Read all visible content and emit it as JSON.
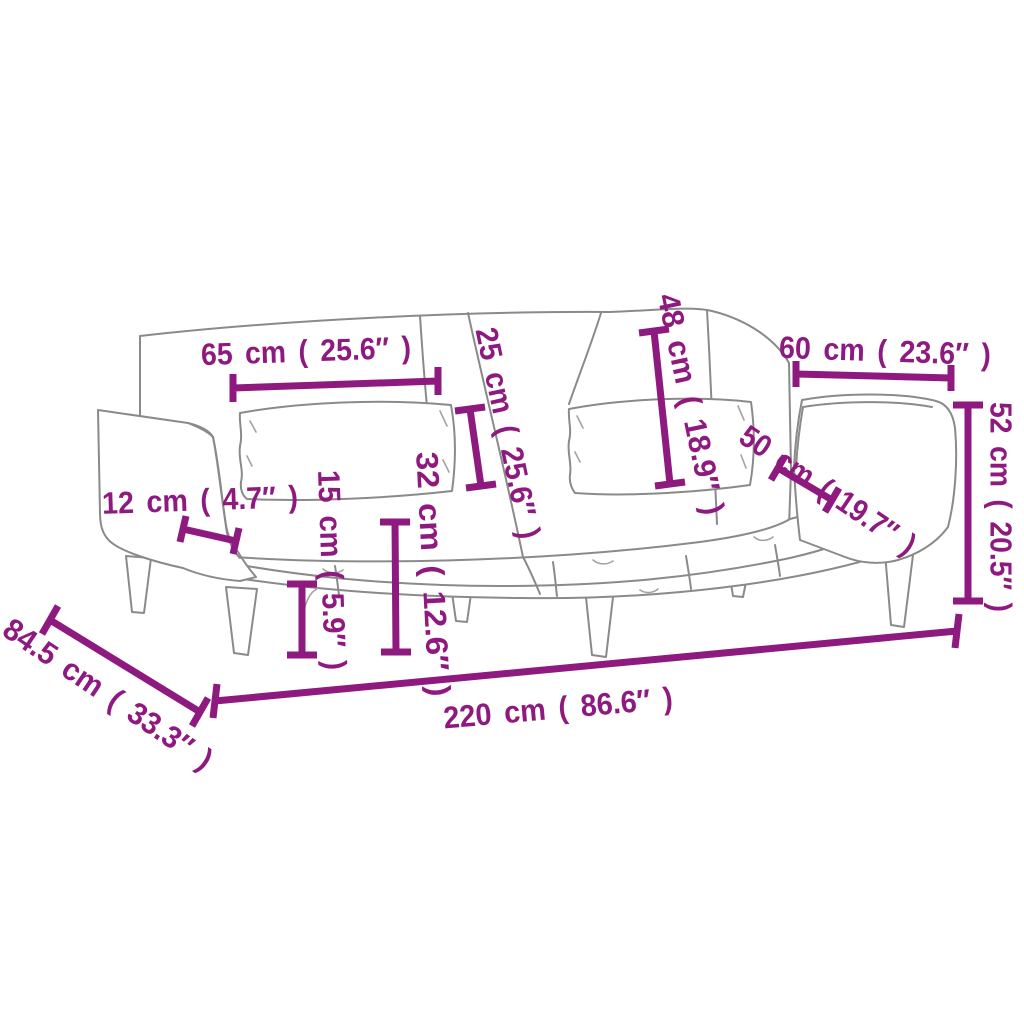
{
  "diagram": {
    "subject": "sofa-bed-dimension-diagram",
    "accent_color": "#8e1a80",
    "line_color": "#8a8a8a",
    "background_color": "#ffffff",
    "unit_primary": "cm",
    "unit_secondary": "inch"
  },
  "dimensions": [
    {
      "id": "dim-65",
      "label": "65 cm ( 25.6″ )"
    },
    {
      "id": "dim-25",
      "label": "25 cm ( 25.6″ )"
    },
    {
      "id": "dim-48",
      "label": "48 cm ( 18.9″ )"
    },
    {
      "id": "dim-60",
      "label": "60 cm ( 23.6″ )"
    },
    {
      "id": "dim-50",
      "label": "50 cm ( 19.7″ )"
    },
    {
      "id": "dim-52",
      "label": "52 cm ( 20.5″ )"
    },
    {
      "id": "dim-12",
      "label": "12 cm ( 4.7″ )"
    },
    {
      "id": "dim-15",
      "label": "15 cm ( 5.9″ )"
    },
    {
      "id": "dim-32",
      "label": "32 cm ( 12.6″ )"
    },
    {
      "id": "dim-845",
      "label": "84.5 cm ( 33.3″ )"
    },
    {
      "id": "dim-220",
      "label": "220 cm ( 86.6″ )"
    }
  ]
}
